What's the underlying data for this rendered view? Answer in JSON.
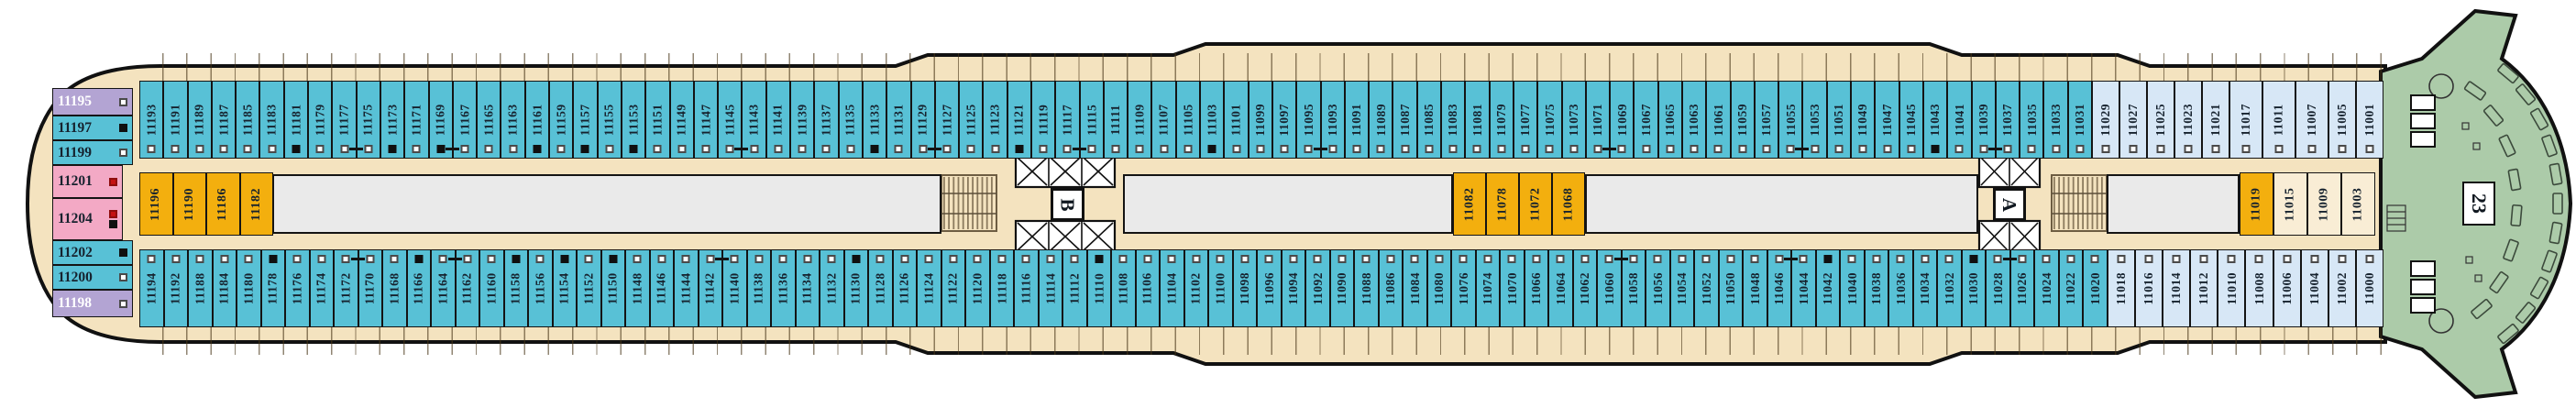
{
  "deck_labels": {
    "forward_deck": "23",
    "elevator_lobby_a": "A",
    "elevator_lobby_b": "B"
  },
  "colors": {
    "teal": "#58C1D6",
    "lblue": "#D7E7F6",
    "orange": "#F3AF0E",
    "cream": "#F9EDD5",
    "pink": "#F3A9C5",
    "purple": "#B3A4D3",
    "beige": "#F4E3BF",
    "corridor": "#EAEAEA",
    "green": "#ACCBA9",
    "ink": "#141414",
    "marker_red": "#C41212"
  },
  "rows": {
    "top": [
      {
        "n": "11193",
        "m": "w"
      },
      {
        "n": "11191",
        "m": "w"
      },
      {
        "n": "11189",
        "m": "w"
      },
      {
        "n": "11187",
        "m": "w"
      },
      {
        "n": "11185",
        "m": "w"
      },
      {
        "n": "11183",
        "m": "w"
      },
      {
        "n": "11181",
        "m": "b"
      },
      {
        "n": "11179",
        "m": "w"
      },
      {
        "n": "11177",
        "m": "w"
      },
      {
        "n": "11175",
        "m": "w",
        "x": 1
      },
      {
        "n": "11173",
        "m": "b"
      },
      {
        "n": "11171",
        "m": "w"
      },
      {
        "n": "11169",
        "m": "b"
      },
      {
        "n": "11167",
        "m": "w",
        "x": 1
      },
      {
        "n": "11165",
        "m": "w"
      },
      {
        "n": "11163",
        "m": "w"
      },
      {
        "n": "11161",
        "m": "b"
      },
      {
        "n": "11159",
        "m": "w"
      },
      {
        "n": "11157",
        "m": "b"
      },
      {
        "n": "11155",
        "m": "w"
      },
      {
        "n": "11153",
        "m": "b"
      },
      {
        "n": "11151",
        "m": "w"
      },
      {
        "n": "11149",
        "m": "w"
      },
      {
        "n": "11147",
        "m": "w"
      },
      {
        "n": "11145",
        "m": "w"
      },
      {
        "n": "11143",
        "m": "w",
        "x": 1
      },
      {
        "n": "11141",
        "m": "w"
      },
      {
        "n": "11139",
        "m": "w"
      },
      {
        "n": "11137",
        "m": "w"
      },
      {
        "n": "11135",
        "m": "w"
      },
      {
        "n": "11133",
        "m": "b"
      },
      {
        "n": "11131",
        "m": "w"
      },
      {
        "n": "11129",
        "m": "w"
      },
      {
        "n": "11127",
        "m": "w",
        "x": 1
      },
      {
        "n": "11125",
        "m": "w"
      },
      {
        "n": "11123",
        "m": "w"
      },
      {
        "n": "11121",
        "m": "b"
      },
      {
        "n": "11119",
        "m": "w"
      },
      {
        "n": "11117",
        "m": "w"
      },
      {
        "n": "11115",
        "m": "w",
        "x": 1
      },
      {
        "n": "11111",
        "m": "w"
      },
      {
        "n": "11109",
        "m": "w"
      },
      {
        "n": "11107",
        "m": "w"
      },
      {
        "n": "11105",
        "m": "w"
      },
      {
        "n": "11103",
        "m": "b"
      },
      {
        "n": "11101",
        "m": "w"
      },
      {
        "n": "11099",
        "m": "w"
      },
      {
        "n": "11097",
        "m": "w"
      },
      {
        "n": "11095",
        "m": "w"
      },
      {
        "n": "11093",
        "m": "w",
        "x": 1
      },
      {
        "n": "11091",
        "m": "w"
      },
      {
        "n": "11089",
        "m": "w"
      },
      {
        "n": "11087",
        "m": "w"
      },
      {
        "n": "11085",
        "m": "w"
      },
      {
        "n": "11083",
        "m": "w"
      },
      {
        "n": "11081",
        "m": "w"
      },
      {
        "n": "11079",
        "m": "w"
      },
      {
        "n": "11077",
        "m": "w"
      },
      {
        "n": "11075",
        "m": "w"
      },
      {
        "n": "11073",
        "m": "w"
      },
      {
        "n": "11071",
        "m": "w"
      },
      {
        "n": "11069",
        "m": "w",
        "x": 1
      },
      {
        "n": "11067",
        "m": "w"
      },
      {
        "n": "11065",
        "m": "w"
      },
      {
        "n": "11063",
        "m": "w"
      },
      {
        "n": "11061",
        "m": "w"
      },
      {
        "n": "11059",
        "m": "w"
      },
      {
        "n": "11057",
        "m": "w"
      },
      {
        "n": "11055",
        "m": "w"
      },
      {
        "n": "11053",
        "m": "w",
        "x": 1
      },
      {
        "n": "11051",
        "m": "w"
      },
      {
        "n": "11049",
        "m": "w"
      },
      {
        "n": "11047",
        "m": "w"
      },
      {
        "n": "11045",
        "m": "w"
      },
      {
        "n": "11043",
        "m": "b"
      },
      {
        "n": "11041",
        "m": "w"
      },
      {
        "n": "11039",
        "m": "w"
      },
      {
        "n": "11037",
        "m": "w",
        "x": 1
      },
      {
        "n": "11035",
        "m": "w"
      },
      {
        "n": "11033",
        "m": "w"
      },
      {
        "n": "11031",
        "m": "w"
      },
      {
        "n": "11029",
        "m": "w",
        "c": "lblue",
        "f": 1.15
      },
      {
        "n": "11027",
        "m": "w",
        "c": "lblue",
        "f": 1.15
      },
      {
        "n": "11025",
        "m": "w",
        "c": "lblue",
        "f": 1.15
      },
      {
        "n": "11023",
        "m": "w",
        "c": "lblue",
        "f": 1.15
      },
      {
        "n": "11021",
        "m": "w",
        "c": "lblue",
        "f": 1.15
      },
      {
        "n": "11017",
        "m": "w",
        "c": "lblue",
        "f": 1.4
      },
      {
        "n": "11011",
        "m": "w",
        "c": "lblue",
        "f": 1.4
      },
      {
        "n": "11007",
        "m": "w",
        "c": "lblue",
        "f": 1.4
      },
      {
        "n": "11005",
        "m": "w",
        "c": "lblue",
        "f": 1.15
      },
      {
        "n": "11001",
        "m": "w",
        "c": "lblue",
        "f": 1.15
      }
    ],
    "bottom": [
      {
        "n": "11194",
        "m": "w"
      },
      {
        "n": "11192",
        "m": "w"
      },
      {
        "n": "11188",
        "m": "w"
      },
      {
        "n": "11184",
        "m": "w"
      },
      {
        "n": "11180",
        "m": "w"
      },
      {
        "n": "11178",
        "m": "b"
      },
      {
        "n": "11176",
        "m": "w"
      },
      {
        "n": "11174",
        "m": "w"
      },
      {
        "n": "11172",
        "m": "w"
      },
      {
        "n": "11170",
        "m": "w",
        "x": 1
      },
      {
        "n": "11168",
        "m": "w"
      },
      {
        "n": "11166",
        "m": "b"
      },
      {
        "n": "11164",
        "m": "w"
      },
      {
        "n": "11162",
        "m": "w",
        "x": 1
      },
      {
        "n": "11160",
        "m": "w"
      },
      {
        "n": "11158",
        "m": "b"
      },
      {
        "n": "11156",
        "m": "w"
      },
      {
        "n": "11154",
        "m": "b"
      },
      {
        "n": "11152",
        "m": "w"
      },
      {
        "n": "11150",
        "m": "b"
      },
      {
        "n": "11148",
        "m": "w"
      },
      {
        "n": "11146",
        "m": "w"
      },
      {
        "n": "11144",
        "m": "w"
      },
      {
        "n": "11142",
        "m": "w"
      },
      {
        "n": "11140",
        "m": "w",
        "x": 1
      },
      {
        "n": "11138",
        "m": "w"
      },
      {
        "n": "11136",
        "m": "w"
      },
      {
        "n": "11134",
        "m": "w"
      },
      {
        "n": "11132",
        "m": "w"
      },
      {
        "n": "11130",
        "m": "b"
      },
      {
        "n": "11128",
        "m": "w"
      },
      {
        "n": "11126",
        "m": "w"
      },
      {
        "n": "11124",
        "m": "w"
      },
      {
        "n": "11122",
        "m": "w"
      },
      {
        "n": "11120",
        "m": "w"
      },
      {
        "n": "11118",
        "m": "w"
      },
      {
        "n": "11116",
        "m": "w"
      },
      {
        "n": "11114",
        "m": "w"
      },
      {
        "n": "11112",
        "m": "w"
      },
      {
        "n": "11110",
        "m": "b"
      },
      {
        "n": "11108",
        "m": "w"
      },
      {
        "n": "11106",
        "m": "w"
      },
      {
        "n": "11104",
        "m": "w"
      },
      {
        "n": "11102",
        "m": "w"
      },
      {
        "n": "11100",
        "m": "w"
      },
      {
        "n": "11098",
        "m": "w"
      },
      {
        "n": "11096",
        "m": "w"
      },
      {
        "n": "11094",
        "m": "w"
      },
      {
        "n": "11092",
        "m": "w"
      },
      {
        "n": "11090",
        "m": "w"
      },
      {
        "n": "11088",
        "m": "w"
      },
      {
        "n": "11086",
        "m": "w"
      },
      {
        "n": "11084",
        "m": "w"
      },
      {
        "n": "11080",
        "m": "w"
      },
      {
        "n": "11076",
        "m": "w"
      },
      {
        "n": "11074",
        "m": "w"
      },
      {
        "n": "11070",
        "m": "w"
      },
      {
        "n": "11066",
        "m": "w"
      },
      {
        "n": "11064",
        "m": "w"
      },
      {
        "n": "11062",
        "m": "w"
      },
      {
        "n": "11060",
        "m": "w"
      },
      {
        "n": "11058",
        "m": "w",
        "x": 1
      },
      {
        "n": "11056",
        "m": "w"
      },
      {
        "n": "11054",
        "m": "w"
      },
      {
        "n": "11052",
        "m": "w"
      },
      {
        "n": "11050",
        "m": "w"
      },
      {
        "n": "11048",
        "m": "w"
      },
      {
        "n": "11046",
        "m": "w"
      },
      {
        "n": "11044",
        "m": "w",
        "x": 1
      },
      {
        "n": "11042",
        "m": "b"
      },
      {
        "n": "11040",
        "m": "w"
      },
      {
        "n": "11038",
        "m": "w"
      },
      {
        "n": "11036",
        "m": "w"
      },
      {
        "n": "11034",
        "m": "w"
      },
      {
        "n": "11032",
        "m": "w"
      },
      {
        "n": "11030",
        "m": "b"
      },
      {
        "n": "11028",
        "m": "w"
      },
      {
        "n": "11026",
        "m": "w",
        "x": 1
      },
      {
        "n": "11024",
        "m": "w"
      },
      {
        "n": "11022",
        "m": "w"
      },
      {
        "n": "11020",
        "m": "w"
      },
      {
        "n": "11018",
        "m": "w",
        "c": "lblue",
        "f": 1.15
      },
      {
        "n": "11016",
        "m": "w",
        "c": "lblue",
        "f": 1.15
      },
      {
        "n": "11014",
        "m": "w",
        "c": "lblue",
        "f": 1.15
      },
      {
        "n": "11012",
        "m": "w",
        "c": "lblue",
        "f": 1.15
      },
      {
        "n": "11010",
        "m": "w",
        "c": "lblue",
        "f": 1.15
      },
      {
        "n": "11008",
        "m": "w",
        "c": "lblue",
        "f": 1.15
      },
      {
        "n": "11006",
        "m": "w",
        "c": "lblue",
        "f": 1.15
      },
      {
        "n": "11004",
        "m": "w",
        "c": "lblue",
        "f": 1.15
      },
      {
        "n": "11002",
        "m": "w",
        "c": "lblue",
        "f": 1.15
      },
      {
        "n": "11000",
        "m": "w",
        "c": "lblue",
        "f": 1.15
      }
    ],
    "stern": [
      {
        "n": "11195",
        "c": "purple",
        "m": "w",
        "h": 30
      },
      {
        "n": "11197",
        "c": "teal",
        "m": "b",
        "h": 27
      },
      {
        "n": "11199",
        "c": "teal",
        "m": "w",
        "h": 27
      },
      {
        "n": "11201",
        "c": "pink",
        "m": "r",
        "h": 36
      },
      {
        "n": "11204",
        "c": "pink",
        "m": "rb",
        "h": 46
      },
      {
        "n": "11202",
        "c": "teal",
        "m": "b",
        "h": 27
      },
      {
        "n": "11200",
        "c": "teal",
        "m": "w",
        "h": 27
      },
      {
        "n": "11198",
        "c": "purple",
        "m": "w",
        "h": 30
      }
    ],
    "mid_left": [
      {
        "n": "11196",
        "c": "orange"
      },
      {
        "n": "11190",
        "c": "orange"
      },
      {
        "n": "11186",
        "c": "orange"
      },
      {
        "n": "11182",
        "c": "orange"
      }
    ],
    "mid_center": [
      {
        "n": "11082",
        "c": "orange"
      },
      {
        "n": "11078",
        "c": "orange"
      },
      {
        "n": "11072",
        "c": "orange"
      },
      {
        "n": "11068",
        "c": "orange"
      }
    ],
    "mid_right": [
      {
        "n": "11019",
        "c": "orange"
      },
      {
        "n": "11015",
        "c": "cream"
      },
      {
        "n": "11009",
        "c": "cream"
      },
      {
        "n": "11003",
        "c": "cream"
      }
    ]
  }
}
